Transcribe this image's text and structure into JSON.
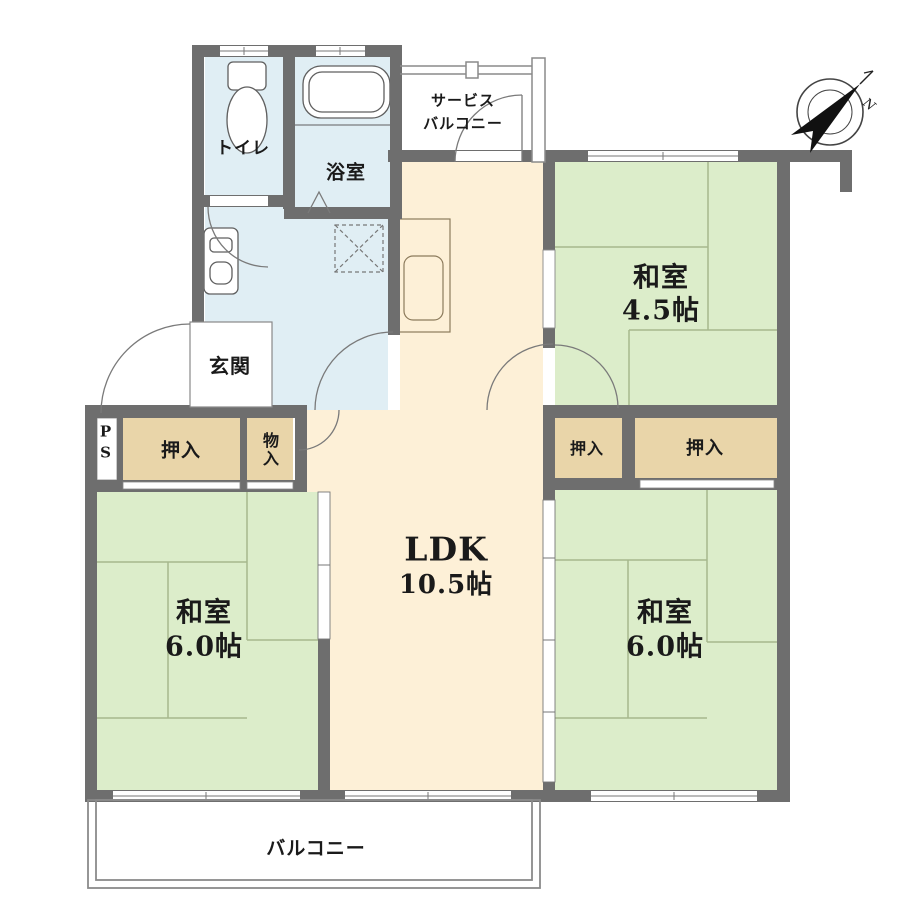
{
  "colors": {
    "wall": "#6e6e6e",
    "tatami": "#dcedca",
    "tatami_line": "#a6b88d",
    "floor": "#fdf0d7",
    "wet_area": "#e0eef4",
    "closet": "#e9d5a9",
    "outline": "#6b6b6b",
    "text": "#1a1a1a"
  },
  "rooms": {
    "toilet": {
      "label": "トイレ"
    },
    "bath": {
      "label": "浴室"
    },
    "service_balcony": {
      "label_line1": "サービス",
      "label_line2": "バルコニー"
    },
    "japanese_room_45": {
      "name": "和室",
      "size": "4.5帖"
    },
    "entrance": {
      "label": "玄関"
    },
    "pipe_space": {
      "line1": "P",
      "line2": "S"
    },
    "closet_west": {
      "label": "押入"
    },
    "storage": {
      "label": "物入"
    },
    "closet_east_small": {
      "label": "押入"
    },
    "closet_east_large": {
      "label": "押入"
    },
    "ldk": {
      "name": "LDK",
      "size": "10.5帖"
    },
    "japanese_room_west": {
      "name": "和室",
      "size": "6.0帖"
    },
    "japanese_room_east": {
      "name": "和室",
      "size": "6.0帖"
    },
    "balcony": {
      "label": "バルコニー"
    }
  },
  "compass": {
    "north_label": "N"
  }
}
